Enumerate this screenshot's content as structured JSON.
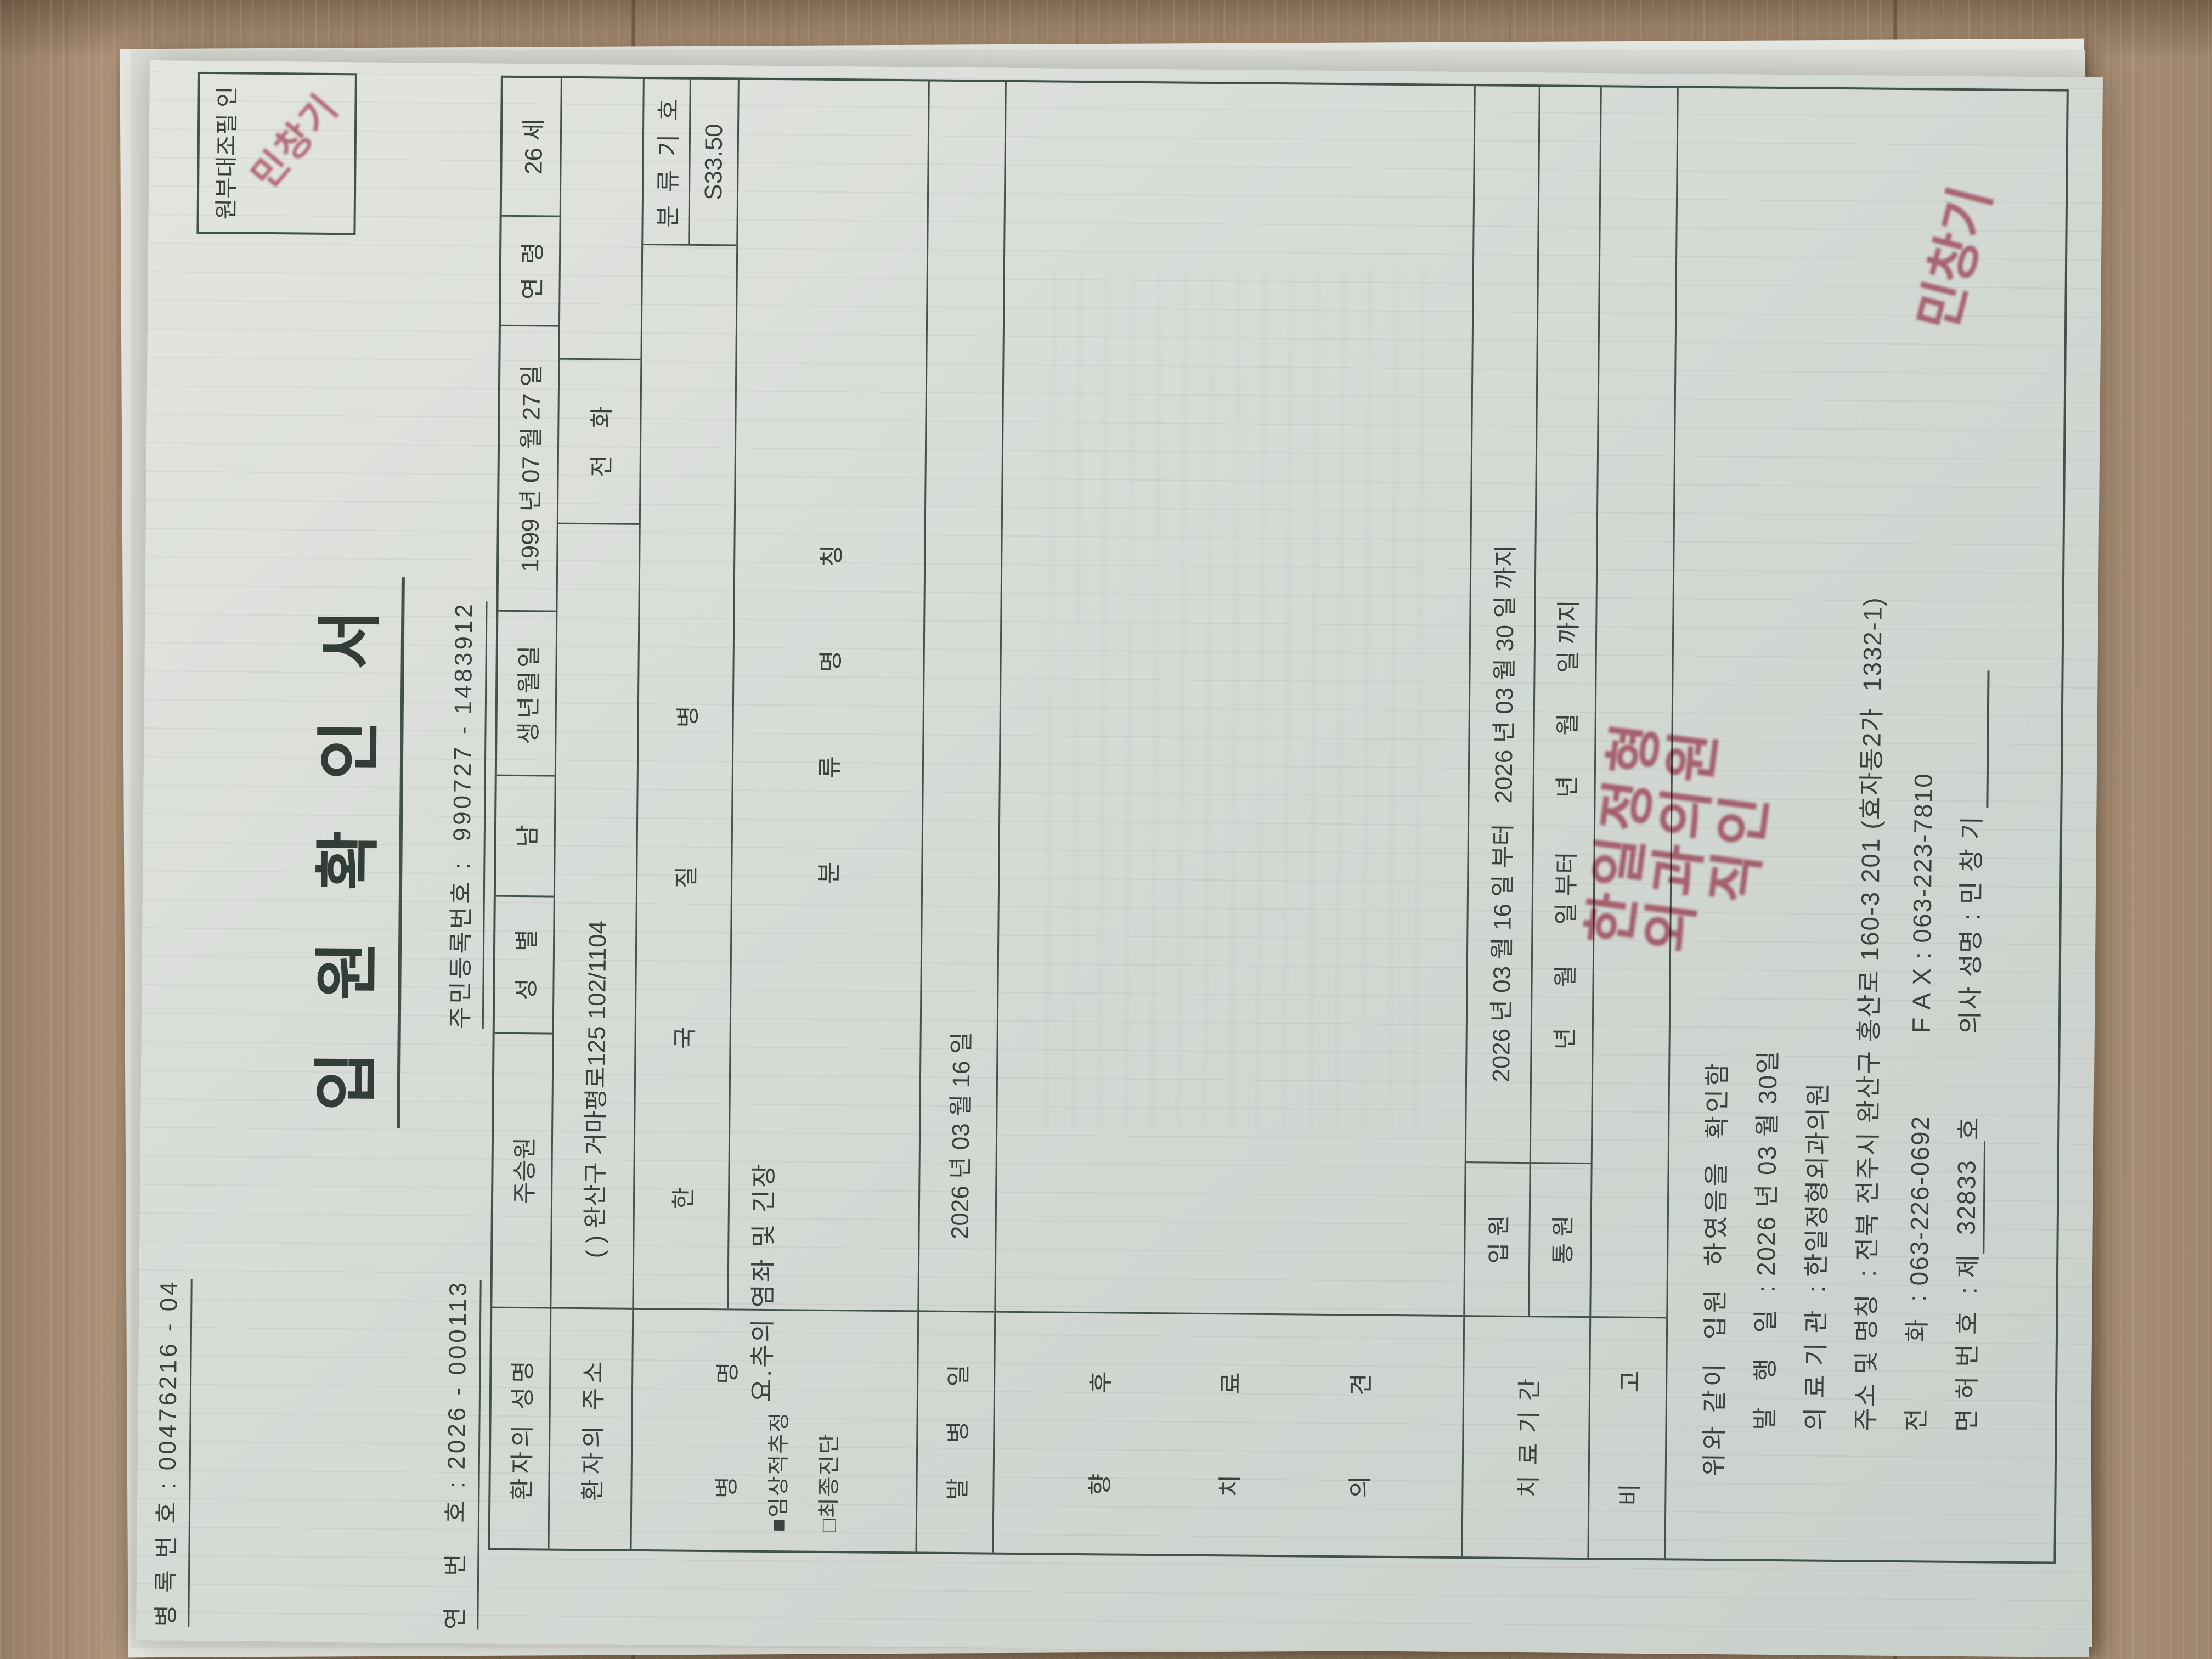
{
  "stamp_box": {
    "label": "원부대조필",
    "suffix": "인",
    "seal_text": "민창기"
  },
  "header": {
    "record_no_line": "병 록 번 호 : 00476216 - 04",
    "title": "입 원 확 인 서",
    "serial_line": "연   번   호 : 2026 - 000113",
    "rrn_line": "주민등록번호 :  990727 - 1483912"
  },
  "table": {
    "row1": {
      "name_label": "환자의 성명",
      "name": "주승원",
      "sex_label": "성    별",
      "sex": "남",
      "birth_label": "생년월일",
      "birth": "1999 년 07 월 27 일",
      "age_label": "연  령",
      "age": "26 세"
    },
    "row2": {
      "addr_label": "환자의 주소",
      "addr": "( ) 완산구 거마평로125 102/1104",
      "tel_label": "전    화",
      "tel": ""
    },
    "row3": {
      "label": [
        "병",
        "명"
      ],
      "clinical_check": "■임상적추정",
      "final_check": "□최종진단",
      "kcd_header_top": "한 국 질 병",
      "kcd_header_bottom": "분 류 명 칭",
      "code_label": "분 류 기 호",
      "code_value": "S33.50",
      "disease_name": "요.추의 염좌 및 긴장"
    },
    "row4": {
      "label": [
        "발",
        "병",
        "일"
      ],
      "value": "2026 년 03 월 16 일"
    },
    "row5": {
      "label_lines": [
        [
          "향",
          "후"
        ],
        [
          "치",
          "료"
        ],
        [
          "의",
          "견"
        ]
      ]
    },
    "row6": {
      "label": "치 료 기 간",
      "inpatient_label": "입 원",
      "inpatient_value": "2026 년 03 월 16 일 부터   2026 년 03 월 30 일 까지",
      "outpatient_label": "통 원",
      "outpatient_value": "년      월      일 부터        년      월      일 까지"
    },
    "row7": {
      "label": [
        "비",
        "고"
      ]
    }
  },
  "footer": {
    "confirm_line": "위와 같이  입원  하였음을  확인함",
    "issue_label": "발   행   일  : ",
    "issue_value": "2026 년 03 월 30일",
    "org_label": "의 료 기 관  : ",
    "org_value": "한일정형외과의원",
    "addr_label": "주소 및 명칭  : ",
    "addr_value": "전북 전주시 완산구 홍산로 160-3 201 (효자동2가  1332-1)",
    "tel_label": "전        화  : ",
    "tel_value": "063-226-0692",
    "fax_label": "F A X : ",
    "fax_value": "063-223-7810",
    "license_label": "면 허 번 호  : ",
    "license_prefix": "제",
    "license_no": "32833",
    "license_suffix": "호",
    "doctor_label": "의사 성명 : ",
    "doctor_name": "민 창 기",
    "org_seal_lines": [
      "한일정형",
      "외과의원",
      "직인"
    ],
    "doctor_seal": "민창기"
  }
}
